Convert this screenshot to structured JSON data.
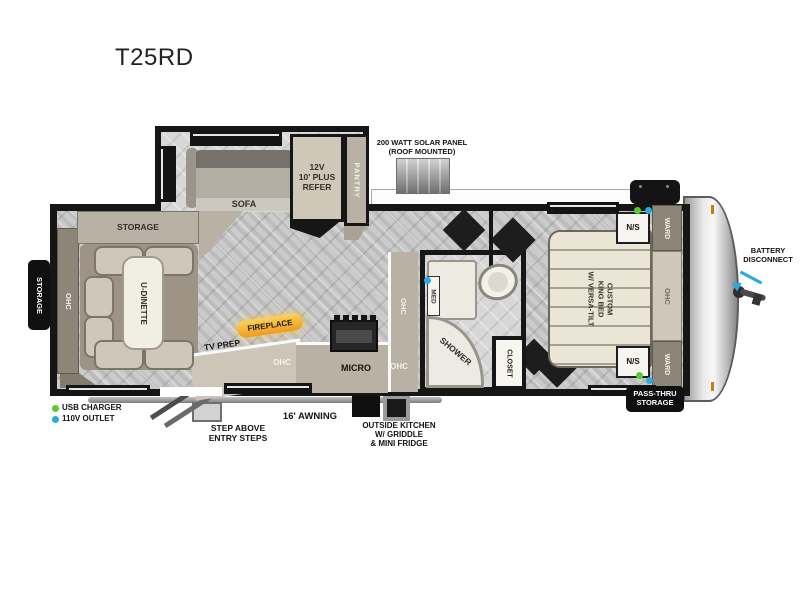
{
  "title": "T25RD",
  "colors": {
    "wall": "#161616",
    "accent_green": "#55cc33",
    "accent_cyan": "#29abe2",
    "fireplace_yellow": "#f0a91e",
    "furniture_taupe": "#b9b1a4",
    "furniture_dark": "#8d8678",
    "bed_beige": "#eae5d5"
  },
  "labels": {
    "title": "T25RD",
    "solar1": "200 WATT SOLAR PANEL",
    "solar2": "(ROOF MOUNTED)",
    "refer1": "12V",
    "refer2": "10' PLUS",
    "refer3": "REFER",
    "pantry": "PANTRY",
    "sofa": "SOFA",
    "storage_dinette": "STORAGE",
    "storage_ext": "STORAGE",
    "ohc_rear": "OHC",
    "u_dinette": "U-DINETTE",
    "fireplace": "FIREPLACE",
    "tv_prep": "TV PREP",
    "ohc_tvprep": "OHC",
    "micro": "MICRO",
    "ohc_micro": "OHC",
    "ohc_kitchen": "OHC",
    "med": "MED",
    "shower": "SHOWER",
    "closet": "CLOSET",
    "ns_top": "N/S",
    "ns_bottom": "N/S",
    "ward_top": "WARD",
    "ward_bottom": "WARD",
    "ohc_bed": "OHC",
    "bed1": "CUSTOM",
    "bed2": "KING BED",
    "bed3": "W/ VERSA-TILT",
    "battery1": "BATTERY",
    "battery2": "DISCONNECT",
    "passthru1": "PASS-THRU",
    "passthru2": "STORAGE",
    "awning": "16' AWNING",
    "steps1": "STEP ABOVE",
    "steps2": "ENTRY STEPS",
    "outkitchen1": "OUTSIDE KITCHEN",
    "outkitchen2": "W/ GRIDDLE",
    "outkitchen3": "& MINI FRIDGE",
    "usb": "USB CHARGER",
    "outlet": "110V OUTLET"
  }
}
